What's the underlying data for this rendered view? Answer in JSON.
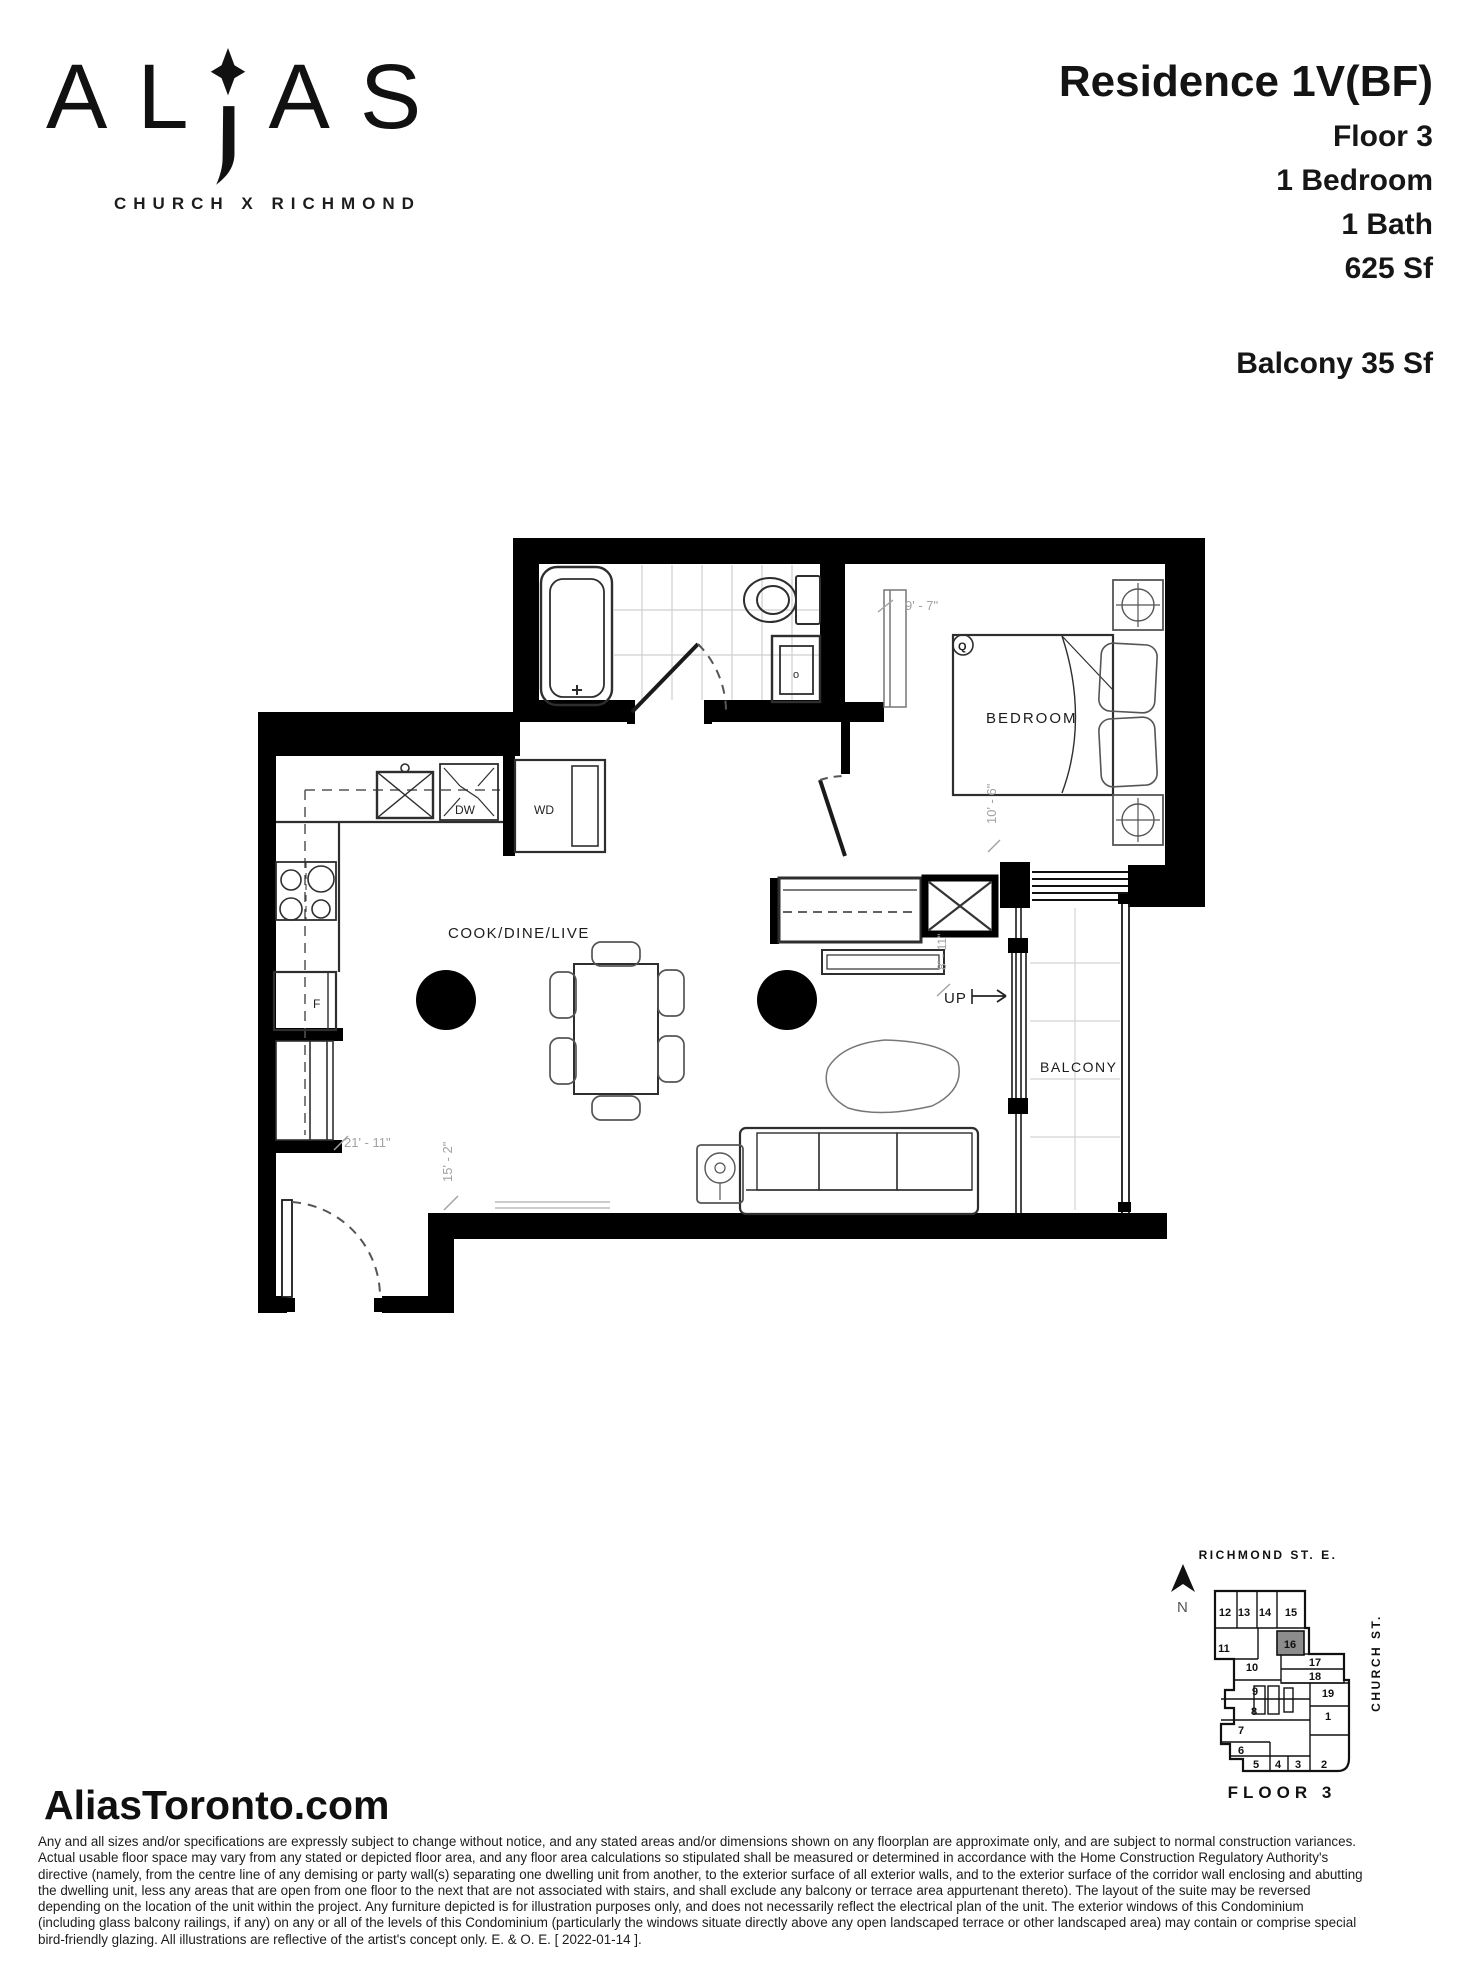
{
  "brand": {
    "logo_part1": "AL",
    "logo_part2": "AS",
    "subtitle": "CHURCH X RICHMOND"
  },
  "header": {
    "residence_title": "Residence 1V(BF)",
    "specs": [
      "Floor 3",
      "1 Bedroom",
      "1 Bath",
      "625 Sf"
    ],
    "balcony": "Balcony 35 Sf"
  },
  "floor_plan": {
    "room_labels": {
      "cook_dine_live": "COOK/DINE/LIVE",
      "bedroom": "BEDROOM",
      "balcony": "BALCONY",
      "up": "UP"
    },
    "appliance_labels": {
      "washer_dryer": "WD",
      "dishwasher": "DW",
      "fridge": "F",
      "bed_size": "Q",
      "sink_faucet": "o"
    },
    "dimensions": {
      "bedroom_width": "9' - 7\"",
      "bedroom_depth": "10' - 6\"",
      "hall_depth": "8' - 11\"",
      "living_width": "21' - 11\"",
      "living_depth": "15' - 2\""
    }
  },
  "key_plan": {
    "street_top": "RICHMOND ST. E.",
    "street_right": "CHURCH ST.",
    "north": "N",
    "floor_label": "FLOOR 3",
    "highlighted_unit": "16",
    "highlight_color": "#8c8c8c",
    "units": [
      "12",
      "13",
      "14",
      "15",
      "11",
      "16",
      "17",
      "18",
      "10",
      "9",
      "19",
      "8",
      "1",
      "7",
      "6",
      "5",
      "4",
      "3",
      "2"
    ]
  },
  "footer": {
    "website": "AliasToronto.com",
    "disclaimer_lines": [
      "Any and all sizes and/or specifications are expressly subject to change without notice, and any stated areas and/or dimensions shown on any floorplan are approximate only, and are subject to normal construction variances.",
      "Actual usable floor space may vary from any stated or depicted floor area, and any floor area calculations so stipulated shall be measured or determined in accordance with the Home Construction Regulatory Authority's",
      "directive (namely, from the centre line of any demising or party wall(s) separating one dwelling unit from another, to the exterior surface of all exterior walls, and to the exterior surface of the corridor wall enclosing and abutting",
      "the dwelling unit, less any areas that are open from one floor to the next that are not associated with stairs, and shall exclude any balcony or terrace area appurtenant thereto). The layout of the suite may be reversed",
      "depending on the location of the unit within the project. Any furniture depicted is for illustration purposes only, and does not necessarily reflect the electrical plan of the unit. The exterior windows of this Condominium",
      "(including glass balcony railings, if any) on any or all of the levels of this Condominium (particularly the windows situate directly above any open landscaped terrace or other landscaped area) may contain or comprise special",
      "bird-friendly glazing. All illustrations are reflective of the artist's concept only. E. & O. E. [ 2022-01-14 ]."
    ]
  }
}
